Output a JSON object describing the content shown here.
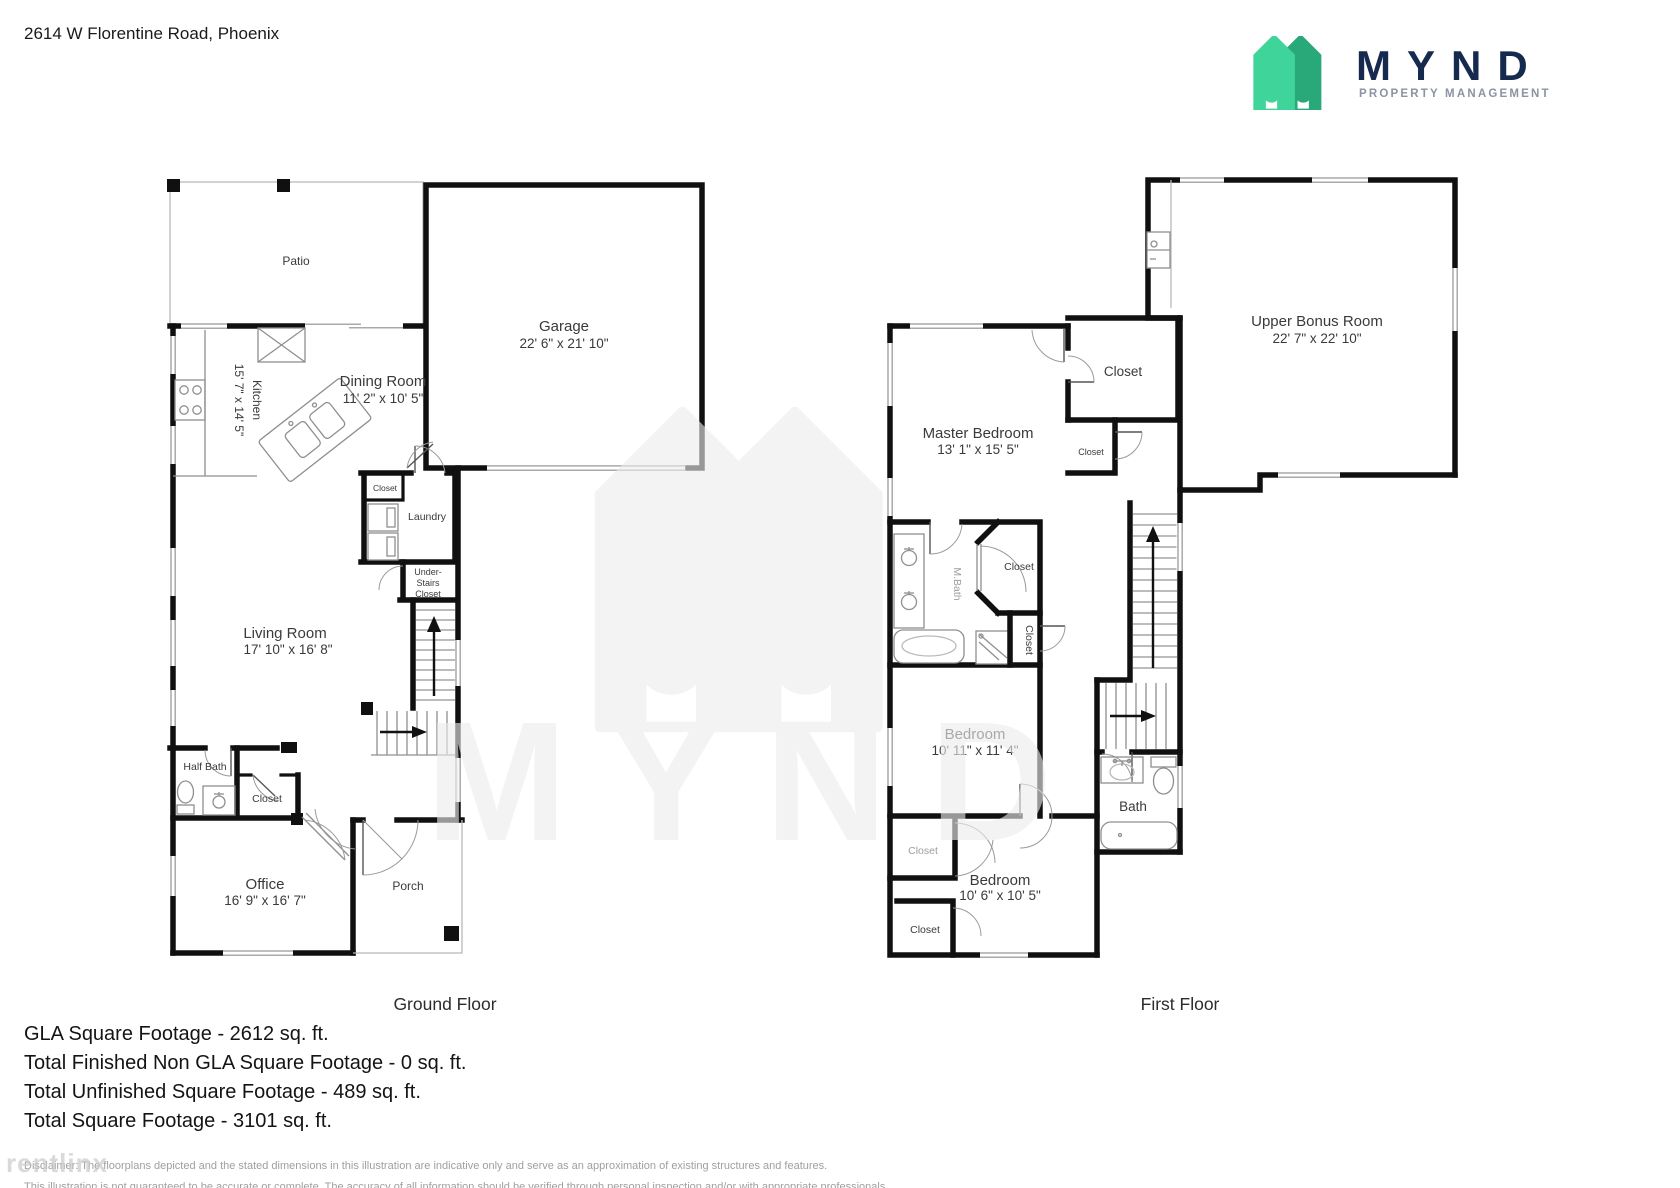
{
  "header": {
    "address": "2614 W Florentine Road, Phoenix",
    "logo": {
      "brand": "MYND",
      "tagline": "PROPERTY MANAGEMENT"
    }
  },
  "colors": {
    "brand_green_light": "#3fd49a",
    "brand_green_dark": "#29a97a",
    "brand_navy": "#162a4f",
    "watermark_gray": "#ececec"
  },
  "ground_floor": {
    "title": "Ground Floor",
    "rooms": {
      "patio": "Patio",
      "garage": {
        "name": "Garage",
        "dims": "22' 6\" x 21' 10\""
      },
      "kitchen": {
        "name": "Kitchen",
        "dims": "15' 7\" x 14' 5\""
      },
      "dining": {
        "name": "Dining Room",
        "dims": "11' 2\" x 10' 5\""
      },
      "laundry_closet": "Closet",
      "laundry": "Laundry",
      "under_stairs": [
        "Under-",
        "Stairs",
        "Closet"
      ],
      "living": {
        "name": "Living Room",
        "dims": "17' 10\" x 16' 8\""
      },
      "half_bath": "Half Bath",
      "hall_closet": "Closet",
      "office": {
        "name": "Office",
        "dims": "16' 9\" x 16' 7\""
      },
      "porch": "Porch"
    }
  },
  "first_floor": {
    "title": "First Floor",
    "rooms": {
      "master": {
        "name": "Master Bedroom",
        "dims": "13' 1\" x 15' 5\""
      },
      "master_closet": "Closet",
      "hall_closet_small": "Closet",
      "bonus": {
        "name": "Upper Bonus Room",
        "dims": "22' 7\" x 22' 10\""
      },
      "mbath": "M.Bath",
      "walkin_closet": "Closet",
      "linen_closet": "Closet",
      "bedroom2": {
        "name": "Bedroom",
        "dims": "10' 11\" x 11' 4\""
      },
      "bath": "Bath",
      "bedroom3_closet": "Closet",
      "bedroom3": {
        "name": "Bedroom",
        "dims": "10' 6\" x 10' 5\""
      },
      "bedroom3_closet2": "Closet"
    }
  },
  "summary": {
    "lines": [
      "GLA Square Footage - 2612 sq. ft.",
      "Total Finished Non GLA Square Footage - 0 sq. ft.",
      "Total Unfinished Square Footage - 489 sq. ft.",
      "Total Square Footage - 3101 sq. ft."
    ]
  },
  "disclaimer": {
    "line1": "Disclaimer: The floorplans depicted and the stated dimensions in this illustration are indicative only and serve as an approximation of existing structures and features.",
    "line2": "This illustration is not guaranteed to be accurate or complete. The accuracy of all information should be verified through personal inspection and/or with appropriate professionals."
  },
  "watermarks": {
    "center": "MYND",
    "corner": "rentlinx"
  }
}
